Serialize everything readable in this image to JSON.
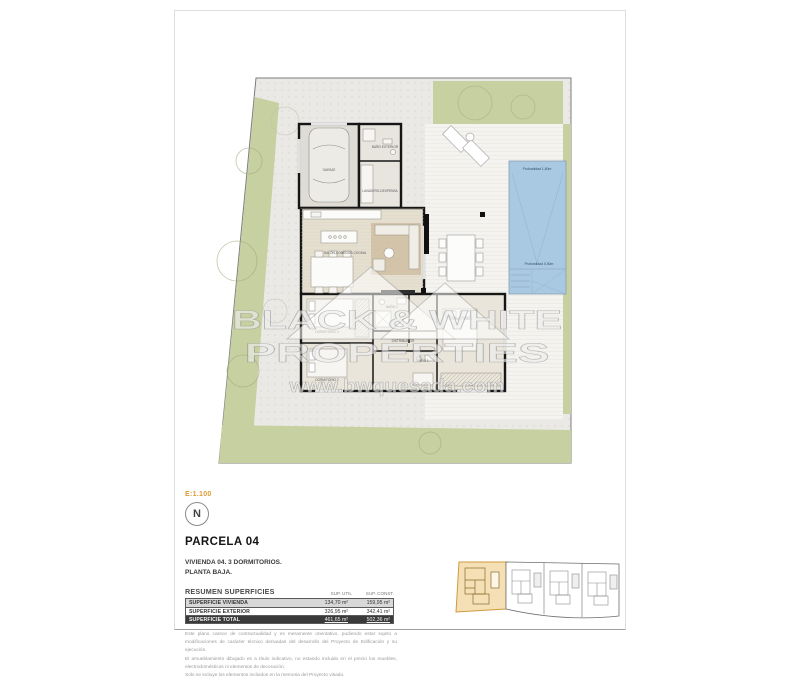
{
  "sheet": {
    "scale": "E:1.100",
    "north": "N",
    "title": "PARCELA 04",
    "subtitle1": "VIVIENDA 04. 3 DORMITORIOS.",
    "subtitle2": "PLANTA BAJA.",
    "accent_color": "#dd9a33"
  },
  "plan": {
    "watermark_line1": "BLACK & WHITE",
    "watermark_line2": "PROPERTIES",
    "watermark_url": "www.bwquesada.com",
    "pool_depth_deep": "Profundidad 1,60m",
    "pool_depth_shallow": "Profundidad 0,50m",
    "pool_color": "#a9c8e1",
    "garden_color": "#c7d0a0",
    "rooms": {
      "garaje": "GARAJE",
      "bano_exterior": "BAÑO EXTERIOR",
      "lavadero": "LAVADERO-DESPENSA",
      "salon": "SALÓN-COMEDOR-COCINA",
      "dormitorio1": "DORMITORIO 1",
      "dormitorio2": "DORMITORIO 2",
      "dormitorio3": "DORMITORIO 3",
      "bano1": "BAÑO 1",
      "bano2": "BAÑO 2",
      "distribuidor": "DISTRIBUIDOR"
    }
  },
  "summary": {
    "title": "RESUMEN SUPERFICIES",
    "col_util": "SUP. UTIL",
    "col_const": "SUP. CONST.",
    "rows": [
      {
        "label": "SUPERFICIE VIVIENDA",
        "util": "134,70 m²",
        "const": "159,95 m²"
      },
      {
        "label": "SUPERFICIE EXTERIOR",
        "util": "326,95 m²",
        "const": "342,41 m²"
      },
      {
        "label": "SUPERFICIE TOTAL",
        "util": "461,65 m²",
        "const": "502,36 m²"
      }
    ]
  },
  "disclaimer": {
    "p1": "Este plano carece de contractualidad y es meramente orientativo, pudiendo estar sujeto a modificaciones de carácter técnico derivadas del desarrollo del Proyecto de Edificación y su ejecución.",
    "p2": "El amueblamiento dibujado es a título indicativo, no estando incluido en el precio los muebles, electrodomésticos ni elementos de decoración.",
    "p3": "Solo se incluye los elementos incluidos en la memoria del Proyecto visado."
  }
}
